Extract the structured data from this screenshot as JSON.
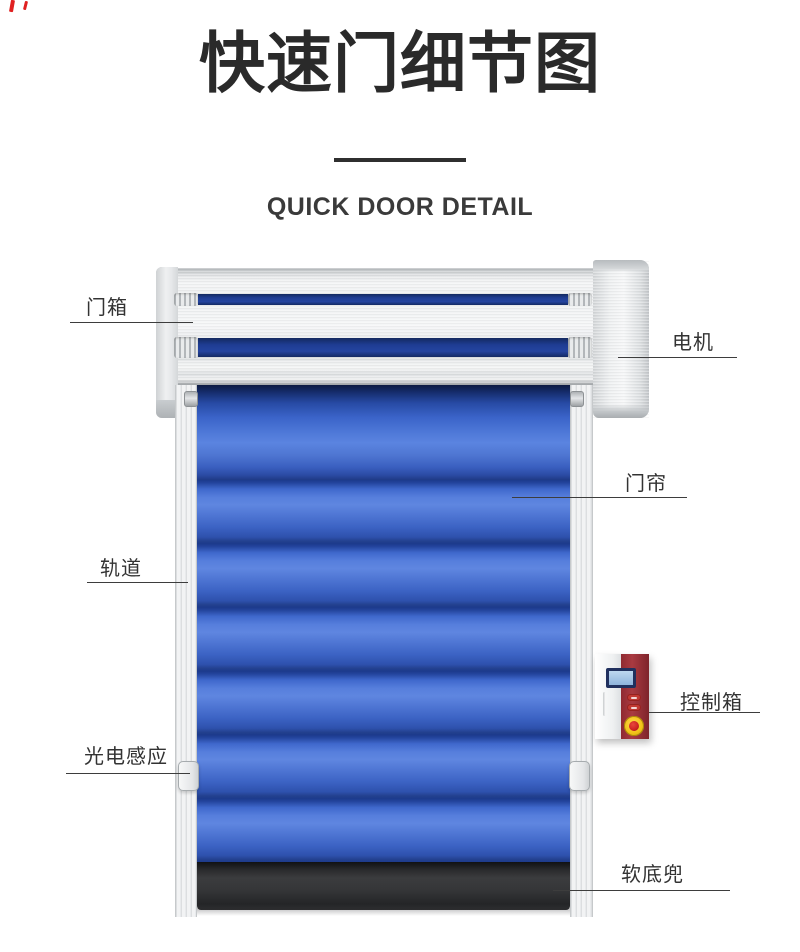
{
  "page": {
    "title": "快速门细节图",
    "subtitle": "QUICK DOOR DETAIL"
  },
  "annotations": {
    "door_box": "门箱",
    "motor": "电机",
    "curtain": "门帘",
    "track": "轨道",
    "control_box": "控制箱",
    "photo_sensor": "光电感应",
    "soft_bottom": "软底兜"
  },
  "colors": {
    "title_text": "#2a2a2a",
    "subtitle_text": "#3a3a3a",
    "divider": "#2f2f2f",
    "label_text": "#333333",
    "leader_line": "#3d3d3d",
    "curtain_blue": "#3a63c8",
    "slot_navy": "#1e3c92",
    "aluminum_light": "#f2f3f4",
    "aluminum_mid": "#d8dadc",
    "control_box_red": "#9e2f36",
    "screen_blue": "#a8c6e8",
    "emergency_yellow": "#f2c318",
    "emergency_red": "#cc2222",
    "pocket_dark": "#303133",
    "corner_mark_red": "#e02020"
  }
}
